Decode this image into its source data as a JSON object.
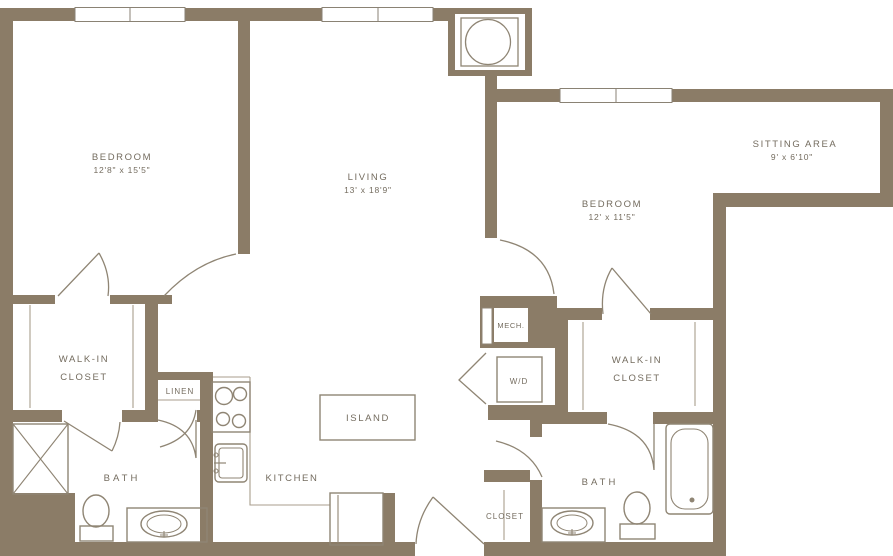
{
  "rooms": {
    "bedroom1": {
      "name": "BEDROOM",
      "dims": "12'8\" x 15'5\""
    },
    "living": {
      "name": "LIVING",
      "dims": "13' x 18'9\""
    },
    "sitting_area": {
      "name": "SITTING AREA",
      "dims": "9' x 6'10\""
    },
    "bedroom2": {
      "name": "BEDROOM",
      "dims": "12' x 11'5\""
    },
    "walk_in_closet_left": {
      "line1": "WALK-IN",
      "line2": "CLOSET"
    },
    "walk_in_closet_right": {
      "line1": "WALK-IN",
      "line2": "CLOSET"
    },
    "linen": {
      "name": "LINEN"
    },
    "mech": {
      "name": "MECH."
    },
    "washer_dryer": {
      "name": "W/D"
    },
    "bath_left": {
      "name": "BATH"
    },
    "bath_right": {
      "name": "BATH"
    },
    "kitchen": {
      "name": "KITCHEN"
    },
    "island": {
      "name": "ISLAND"
    },
    "entry_closet": {
      "name": "CLOSET"
    }
  },
  "colors": {
    "wall": "#8b7c67",
    "fixture_line": "#8f8574",
    "thin_line": "#a89e8d",
    "text": "#746c5f",
    "background": "#ffffff"
  }
}
